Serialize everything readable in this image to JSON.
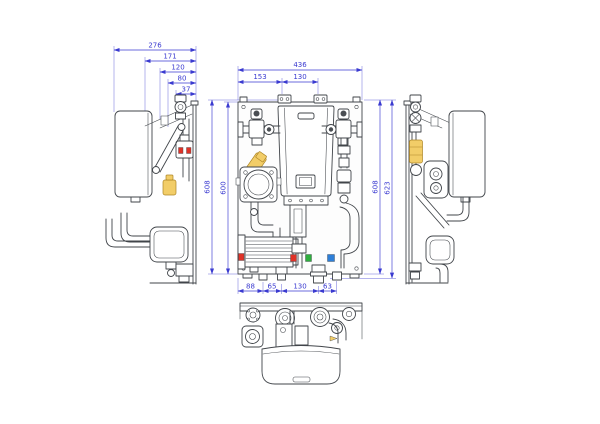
{
  "drawing": {
    "type": "technical-drawing",
    "subject": "wall-mounted-boiler-hydraulic-module",
    "views": [
      "left-side-view",
      "front-view",
      "right-side-view",
      "bottom-view"
    ]
  },
  "dimensions": {
    "left_top": [
      "276",
      "171",
      "120",
      "80",
      "37"
    ],
    "front_top": [
      "436",
      "153",
      "130"
    ],
    "front_left": [
      "608",
      "600"
    ],
    "front_right": [
      "608",
      "623"
    ],
    "front_bottom": [
      "88",
      "65",
      "130",
      "63"
    ]
  },
  "colors": {
    "dimension_blue": "#3a3ad0",
    "line_dark": "#41454a",
    "brass_yellow": "#f2cd68",
    "brass_outline": "#ad8526",
    "marker_red": "#e03228",
    "marker_green": "#2fae3e",
    "marker_blue": "#2e7fd8",
    "background": "#ffffff"
  }
}
